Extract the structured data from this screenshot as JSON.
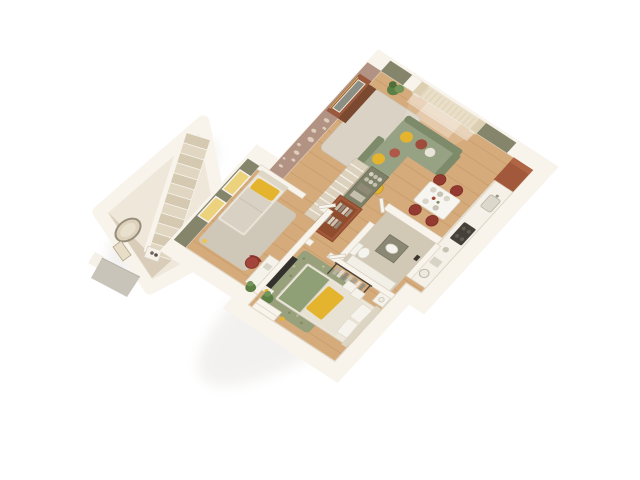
{
  "scene": {
    "description": "isometric 3D floor plan render of a two-structure apartment: entrance stair hall and main upper-floor apartment",
    "view": "top-down isometric",
    "background": "#ffffff"
  },
  "colors": {
    "bg": "#ffffff",
    "wall": "#f8f4ec",
    "wallEdge": "#ddd4c3",
    "floor": "#d6ab7b",
    "plank": "#b98f5e",
    "tile": "#d2c8b6",
    "taupe": "#b29283",
    "mapDecal": "#e2d4c2",
    "olive": "#85856c",
    "curtain": "#e9dfc8",
    "sofa": "#97a284",
    "sofaDark": "#7d8b6b",
    "rugLiving": "#dad3c5",
    "rugBed1": "#cfc8b9",
    "rugBed2": "#98a17b",
    "rugBed2Dot": "#7f8a62",
    "yellow": "#e5b42f",
    "chairRed": "#943a30",
    "terracotta": "#a2583a",
    "terracottaDark": "#8a4a2c",
    "woodBrown": "#7a4930",
    "tvDark": "#33312d",
    "screen": "#8b8e84",
    "shelfOlive": "#7e8168",
    "green1": "#5d7f45",
    "green2": "#74955a",
    "landing": "#d9cdba",
    "mat": "#c9c4ba",
    "glow": "#ecd27c",
    "basin": "#8a8874"
  },
  "structures": {
    "stair_hall": {
      "name": "entrance stair hall",
      "features": [
        "staircase-up",
        "oval-rug",
        "entry-door",
        "shoe-cabinet",
        "doormat"
      ]
    },
    "apartment": {
      "rooms": [
        {
          "name": "living room",
          "furniture": [
            "tv-wall-unit",
            "tv",
            "world-map-decal",
            "corner-sofa",
            "yellow-cushions",
            "round-pouf",
            "area-rug",
            "plant",
            "window-curtains"
          ]
        },
        {
          "name": "dining area",
          "furniture": [
            "dining-table",
            "four-red-chairs",
            "table-setting"
          ]
        },
        {
          "name": "kitchen",
          "furniture": [
            "tall-terracotta-cabinet",
            "counter-run",
            "sink",
            "cooktop",
            "washer"
          ]
        },
        {
          "name": "stair-storage block",
          "furniture": [
            "interior-stairs",
            "olive-shelf",
            "terracotta-wardrobe"
          ]
        },
        {
          "name": "bedroom 1",
          "furniture": [
            "single-bed",
            "yellow-pillow",
            "two-windows",
            "rug",
            "desk",
            "red-desk-chair",
            "plant"
          ]
        },
        {
          "name": "bathroom",
          "furniture": [
            "vanity-with-basin",
            "toilet",
            "bathtub"
          ]
        },
        {
          "name": "bedroom 2",
          "furniture": [
            "double-bed",
            "green-runner",
            "yellow-throw",
            "patterned-rug",
            "clothes-rack",
            "nightstand",
            "lamp",
            "tv-panel",
            "plant"
          ]
        }
      ]
    }
  }
}
